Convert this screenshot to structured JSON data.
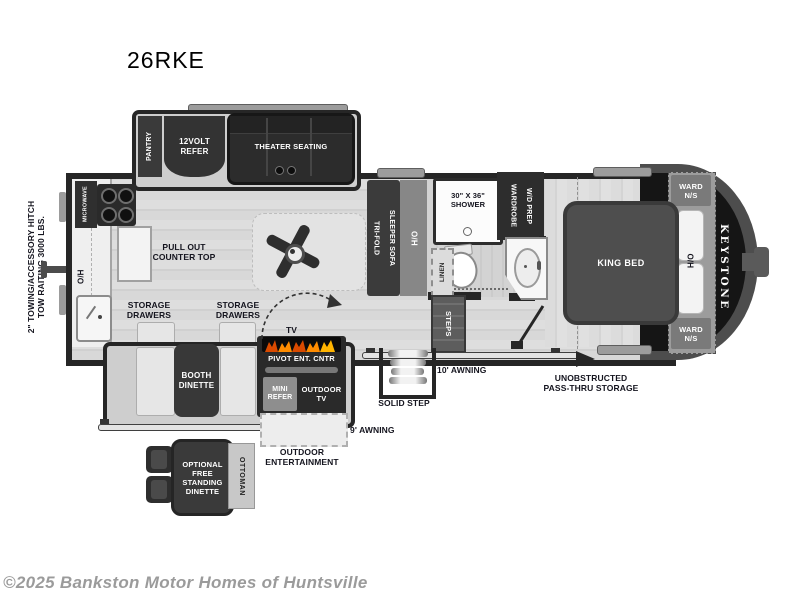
{
  "title": "26RKE",
  "watermark": "©2025 Bankston Motor Homes of Huntsville",
  "brand": "KEYSTONE",
  "colors": {
    "wall": "#262626",
    "floor": "#d8d8d8",
    "dark_furniture": "#333333",
    "flame_accent": "#ff8c00"
  },
  "exterior": {
    "tow_note": "2\" TOWING/ACCESSORY HITCH\nTOW RAITING 3000 LBS.",
    "awning_9": "9' AWNING",
    "awning_10": "10' AWNING",
    "solid_step": "SOLID STEP",
    "pass_thru_storage": "UNOBSTRUCTED\nPASS-THRU STORAGE",
    "outdoor_entertainment": "OUTDOOR\nENTERTAINMENT"
  },
  "slide_top": {
    "pantry": "PANTRY",
    "refer": "12VOLT\nREFER",
    "theater_seating": "THEATER SEATING"
  },
  "kitchen": {
    "microwave": "MICROWAVE",
    "overhead": "O/H",
    "pull_out_counter": "PULL OUT\nCOUNTER TOP",
    "storage_drawers_left": "STORAGE\nDRAWERS",
    "storage_drawers_right": "STORAGE\nDRAWERS"
  },
  "living": {
    "sofa": "TRI-FOLD\nSLEEPER SOFA",
    "sofa_overhead": "O/H",
    "tv": "TV",
    "pivot_ent_cntr": "PIVOT ENT. CNTR",
    "mini_refer": "MINI\nREFER",
    "outdoor_tv": "OUTDOOR\nTV",
    "booth_dinette": "BOOTH\nDINETTE"
  },
  "bath": {
    "shower": "30\" X 36\"\nSHOWER",
    "wardrobe": "WARDROBE\nW/D PREP",
    "linen": "LINEN",
    "steps": "STEPS"
  },
  "bedroom": {
    "king_bed": "KING BED",
    "ward_ns_top": "WARD\nN/S",
    "ward_ns_bottom": "WARD\nN/S",
    "overhead": "H/O"
  },
  "optional": {
    "free_standing_dinette": "OPTIONAL\nFREE\nSTANDING\nDINETTE",
    "ottoman": "OTTOMAN"
  }
}
